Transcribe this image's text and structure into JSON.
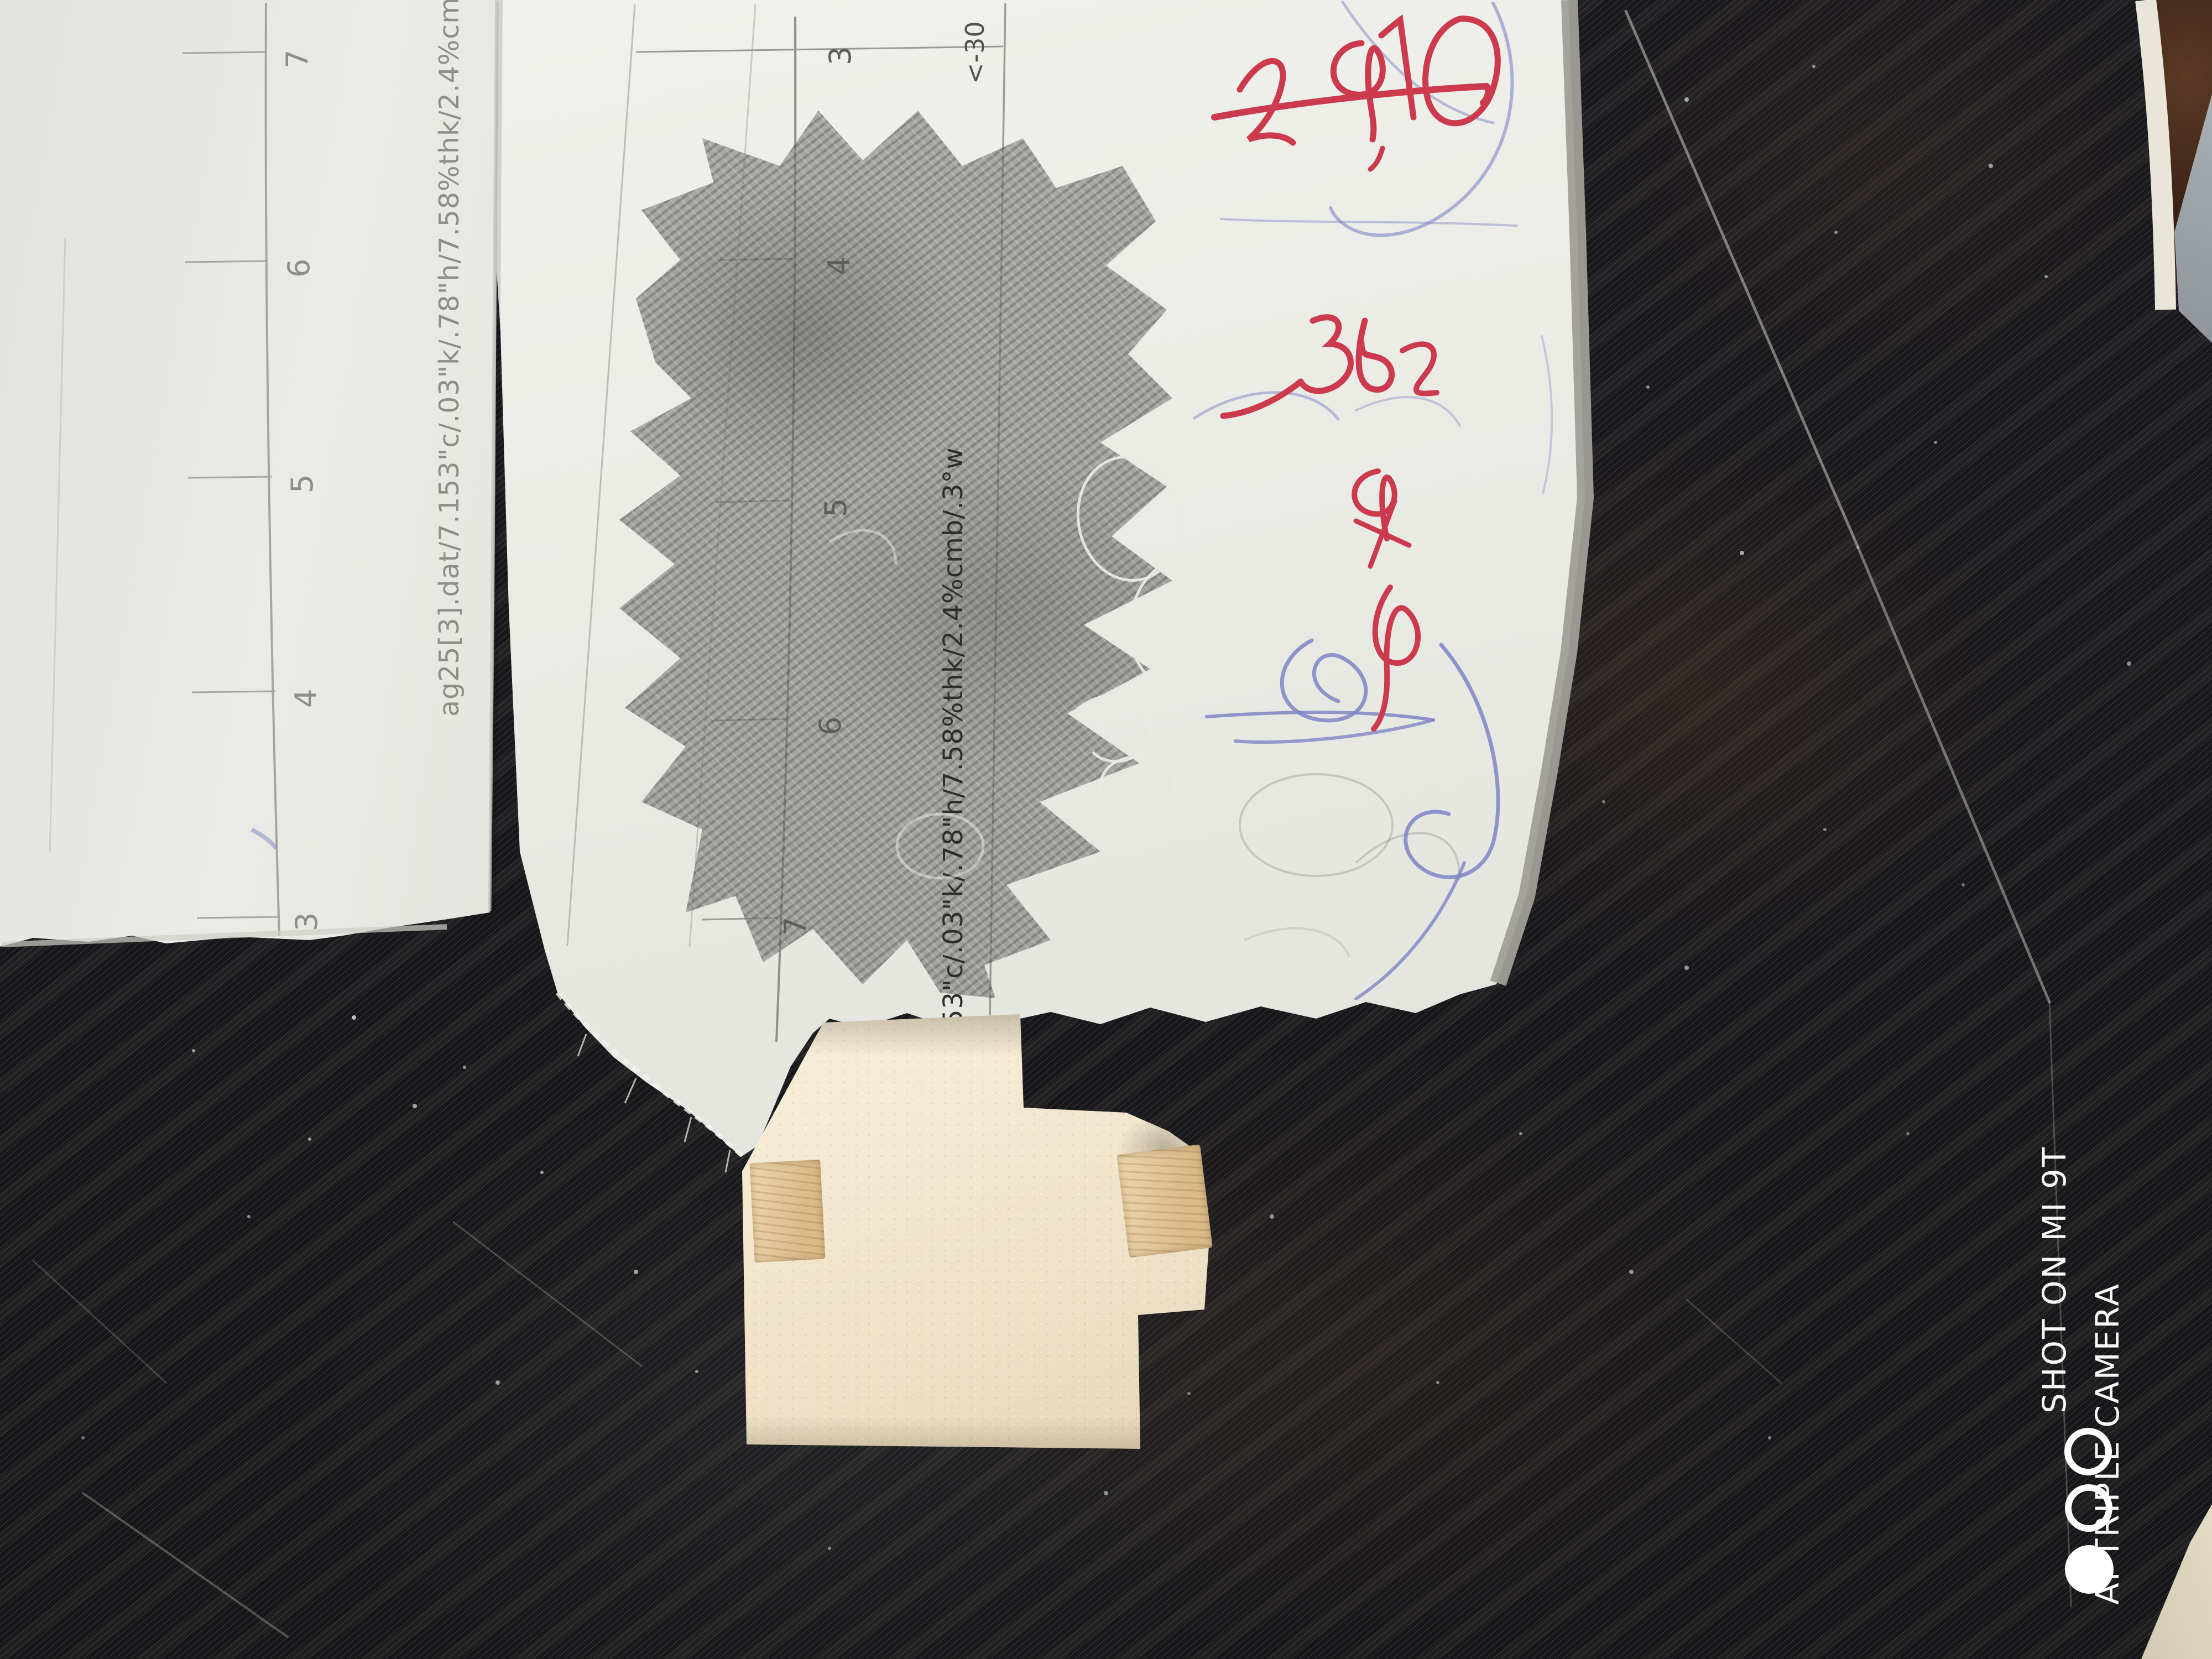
{
  "scene": {
    "surface": "black glossy board with diagonal scratches",
    "background_color": "#141316",
    "streak_color": "#8a8a85"
  },
  "papers": {
    "left": {
      "ruler_numbers": [
        "7",
        "6",
        "5",
        "4",
        "3"
      ],
      "printed_label": "ag25[3].dat/7.153\"c/.03\"k/.78\"h/7.58%thk/2.4%cmb/.3°w"
    },
    "main": {
      "ruler_numbers": [
        "3",
        "4",
        "5",
        "6",
        "7"
      ],
      "corner_label": "<-30",
      "printed_label": "53\"c/.03\"k/.78\"h/7.58%thk/2.4%cmb/.3°w"
    }
  },
  "annotations": {
    "red_ink": {
      "color": "#cc3a4e",
      "row1": "290",
      "row2": "362",
      "row3": "+9",
      "row4": "φ",
      "underline": true
    },
    "blue_ink": {
      "color": "#7e85c4",
      "description": "looping ballpoint scribbles"
    },
    "pencil": {
      "color": "#7e7d79",
      "description": "graphite shading patch"
    }
  },
  "foam": {
    "body_color": "#f1e6cf",
    "wood_tab_color": "#ddc29a"
  },
  "watermark": {
    "line1": "SHOT ON MI 9T",
    "line2": "AI TRIPLE CAMERA",
    "logo_circles": [
      "outline",
      "outline",
      "filled"
    ],
    "color": "#ffffff"
  }
}
